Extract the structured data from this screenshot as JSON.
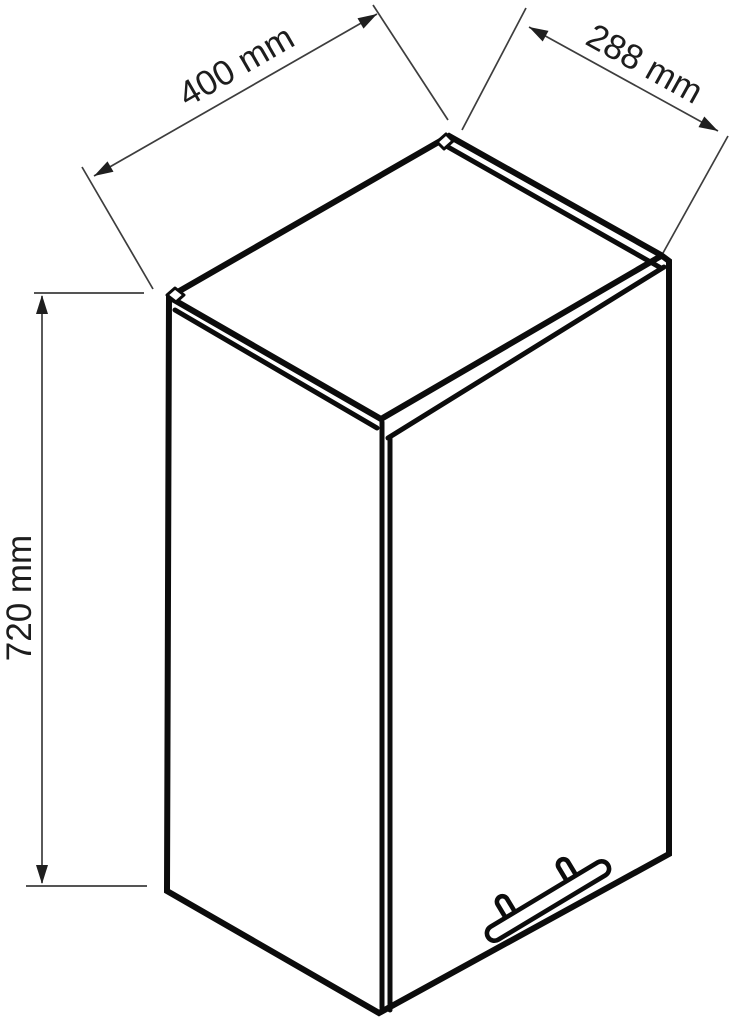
{
  "page": {
    "background_color": "#ffffff",
    "line_color": "#0c0c0c",
    "dimension_line_color": "#3d3d3d",
    "text_color": "#1d1d1d"
  },
  "diagram": {
    "subject": "wall-cabinet-technical-drawing",
    "dimensions": {
      "width": {
        "label": "400 mm"
      },
      "depth": {
        "label": "288 mm"
      },
      "height": {
        "label": "720 mm"
      }
    }
  }
}
